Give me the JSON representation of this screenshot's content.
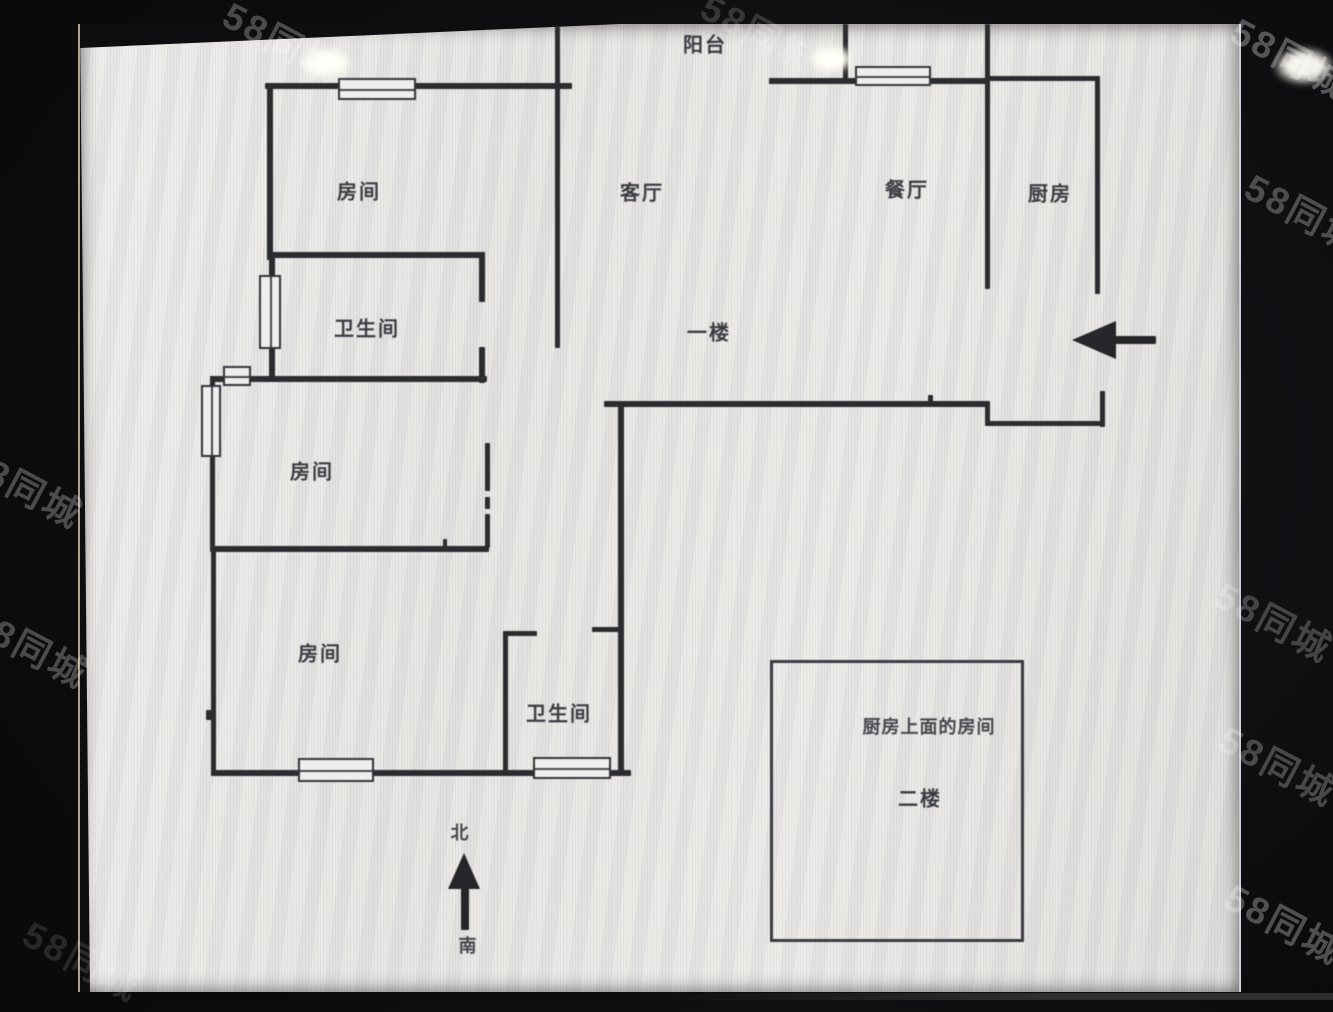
{
  "watermark": {
    "text": "58同城",
    "color": "#ffffff",
    "opacity_dark": 0.28,
    "opacity_photo": 0.1,
    "positions": [
      {
        "x": 240,
        "y": -14,
        "op": 0.25
      },
      {
        "x": 718,
        "y": -22,
        "op": 0.16
      },
      {
        "x": 1248,
        "y": 2,
        "op": 0.3
      },
      {
        "x": 1262,
        "y": 158,
        "op": 0.26
      },
      {
        "x": -18,
        "y": 432,
        "op": 0.26
      },
      {
        "x": -12,
        "y": 592,
        "op": 0.26
      },
      {
        "x": 1232,
        "y": 566,
        "op": 0.22
      },
      {
        "x": 1236,
        "y": 710,
        "op": 0.24
      },
      {
        "x": 1242,
        "y": 868,
        "op": 0.28
      },
      {
        "x": 40,
        "y": 905,
        "op": 0.12
      }
    ]
  },
  "photo": {
    "floor_plan": {
      "line_color": "#2b2b30",
      "labels": [
        {
          "id": "balcony",
          "label": "阳台",
          "x": 625,
          "y": 19,
          "small": false
        },
        {
          "id": "room-upper-left",
          "label": "房间",
          "x": 279,
          "y": 166,
          "small": false
        },
        {
          "id": "living-room",
          "label": "客厅",
          "x": 562,
          "y": 167,
          "small": false
        },
        {
          "id": "dining-room",
          "label": "餐厅",
          "x": 827,
          "y": 164,
          "small": false
        },
        {
          "id": "kitchen",
          "label": "厨房",
          "x": 970,
          "y": 168,
          "small": false
        },
        {
          "id": "bathroom-upper",
          "label": "卫生间",
          "x": 287,
          "y": 303,
          "small": false
        },
        {
          "id": "floor-1",
          "label": "一楼",
          "x": 629,
          "y": 307,
          "small": false
        },
        {
          "id": "room-middle",
          "label": "房间",
          "x": 232,
          "y": 446,
          "small": false
        },
        {
          "id": "room-lower",
          "label": "房间",
          "x": 240,
          "y": 628,
          "small": false
        },
        {
          "id": "bathroom-lower",
          "label": "卫生间",
          "x": 479,
          "y": 688,
          "small": false
        },
        {
          "id": "room-above-kitchen",
          "label": "厨房上面的房间",
          "x": 849,
          "y": 702,
          "small": true
        },
        {
          "id": "floor-2",
          "label": "二楼",
          "x": 840,
          "y": 773,
          "small": false
        },
        {
          "id": "compass-north",
          "label": "北",
          "x": 380,
          "y": 808,
          "small": true
        },
        {
          "id": "compass-south",
          "label": "南",
          "x": 388,
          "y": 921,
          "small": true
        }
      ]
    }
  }
}
